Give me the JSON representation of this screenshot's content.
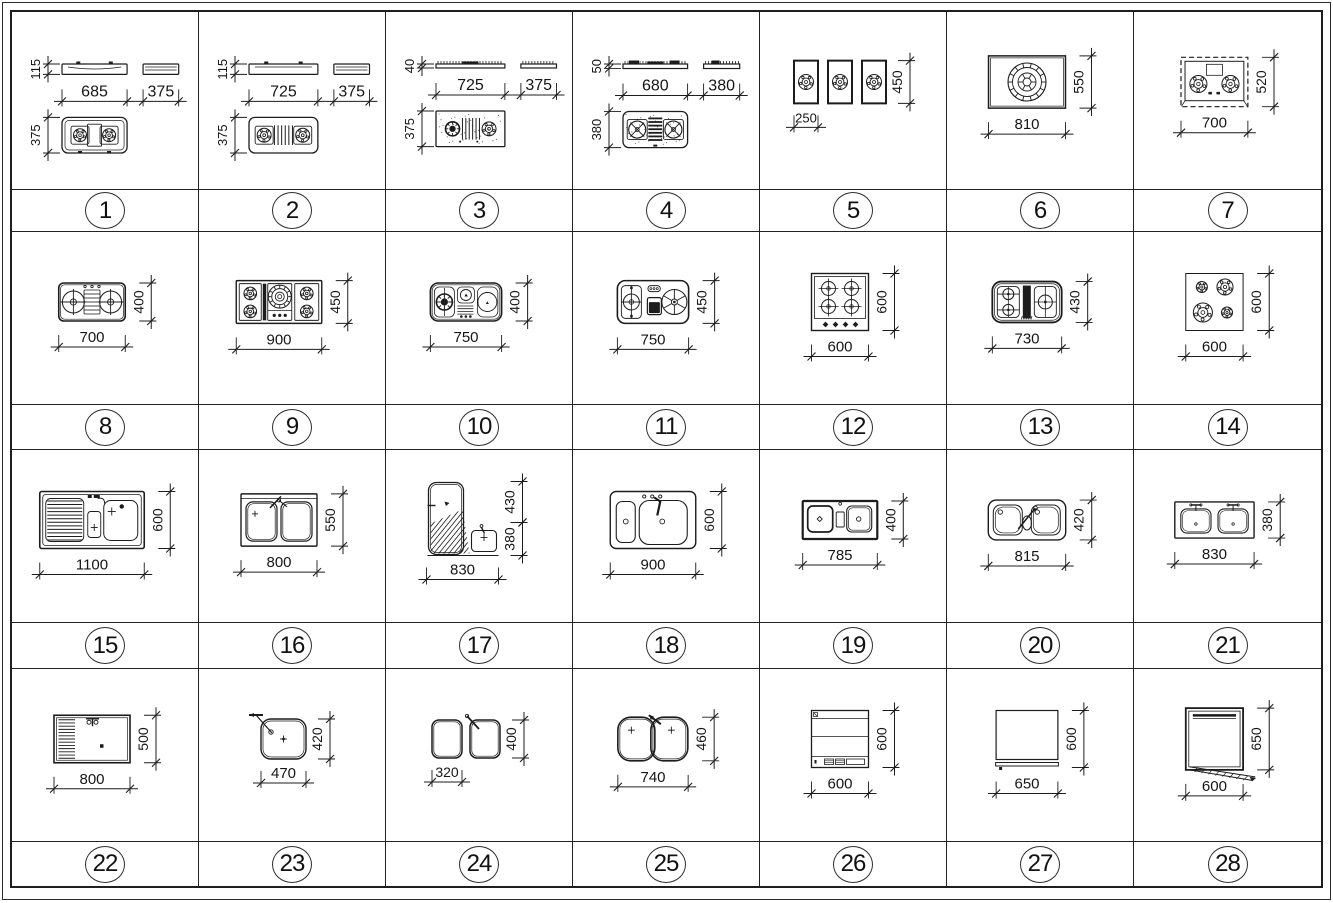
{
  "sheet": {
    "rows": 4,
    "cols": 7,
    "item_count": 28
  },
  "style": {
    "line_color": "#1c1c1c",
    "background": "#ffffff"
  },
  "cells": [
    {
      "num": "1",
      "kind": "hob_side",
      "variant": 1,
      "dims": {
        "height": "115",
        "width": "685",
        "side_width": "375",
        "depth": "375"
      }
    },
    {
      "num": "2",
      "kind": "hob_side",
      "variant": 2,
      "dims": {
        "height": "115",
        "width": "725",
        "side_width": "375",
        "depth": "375"
      }
    },
    {
      "num": "3",
      "kind": "hob_side",
      "variant": 3,
      "dims": {
        "height": "40",
        "width": "725",
        "side_width": "375",
        "depth": "375"
      }
    },
    {
      "num": "4",
      "kind": "hob_side",
      "variant": 4,
      "dims": {
        "height": "50",
        "width": "680",
        "side_width": "380",
        "depth": "380"
      }
    },
    {
      "num": "5",
      "kind": "strips",
      "dims": {
        "width": "250",
        "height": "450"
      }
    },
    {
      "num": "6",
      "kind": "wok",
      "dims": {
        "width": "810",
        "height": "550"
      }
    },
    {
      "num": "7",
      "kind": "dashed2",
      "dims": {
        "width": "700",
        "height": "520"
      }
    },
    {
      "num": "8",
      "kind": "grill2",
      "dims": {
        "width": "700",
        "height": "400"
      }
    },
    {
      "num": "9",
      "kind": "five",
      "dims": {
        "width": "900",
        "height": "450"
      }
    },
    {
      "num": "10",
      "kind": "mixed",
      "dims": {
        "width": "750",
        "height": "400"
      }
    },
    {
      "num": "11",
      "kind": "two_oven",
      "dims": {
        "width": "750",
        "height": "450"
      }
    },
    {
      "num": "12",
      "kind": "four_cross",
      "dims": {
        "width": "600",
        "height": "600"
      }
    },
    {
      "num": "13",
      "kind": "two_black",
      "dims": {
        "width": "730",
        "height": "430"
      }
    },
    {
      "num": "14",
      "kind": "four_round",
      "dims": {
        "width": "600",
        "height": "600"
      }
    },
    {
      "num": "15",
      "kind": "sink_drain",
      "dims": {
        "width": "1100",
        "height": "600"
      }
    },
    {
      "num": "16",
      "kind": "sink16",
      "dims": {
        "width": "800",
        "height": "550"
      }
    },
    {
      "num": "17",
      "kind": "sink_corner",
      "dims": {
        "width": "830",
        "height_top": "430",
        "height_bottom": "380"
      }
    },
    {
      "num": "18",
      "kind": "sink18",
      "dims": {
        "width": "900",
        "height": "600"
      }
    },
    {
      "num": "19",
      "kind": "sink19",
      "dims": {
        "width": "785",
        "height": "400"
      }
    },
    {
      "num": "20",
      "kind": "sink20",
      "dims": {
        "width": "815",
        "height": "420"
      }
    },
    {
      "num": "21",
      "kind": "sink21",
      "dims": {
        "width": "830",
        "height": "380"
      }
    },
    {
      "num": "22",
      "kind": "sink22",
      "dims": {
        "width": "800",
        "height": "500"
      }
    },
    {
      "num": "23",
      "kind": "sink23",
      "dims": {
        "width": "470",
        "height": "420"
      }
    },
    {
      "num": "24",
      "kind": "two_sep",
      "dims": {
        "width": "320",
        "height": "400"
      }
    },
    {
      "num": "25",
      "kind": "sink25",
      "dims": {
        "width": "740",
        "height": "460"
      }
    },
    {
      "num": "26",
      "kind": "dw26",
      "dims": {
        "width": "600",
        "height": "600"
      }
    },
    {
      "num": "27",
      "kind": "dw27",
      "dims": {
        "width": "650",
        "height": "600"
      }
    },
    {
      "num": "28",
      "kind": "dw28",
      "dims": {
        "width": "600",
        "height": "650"
      }
    }
  ]
}
